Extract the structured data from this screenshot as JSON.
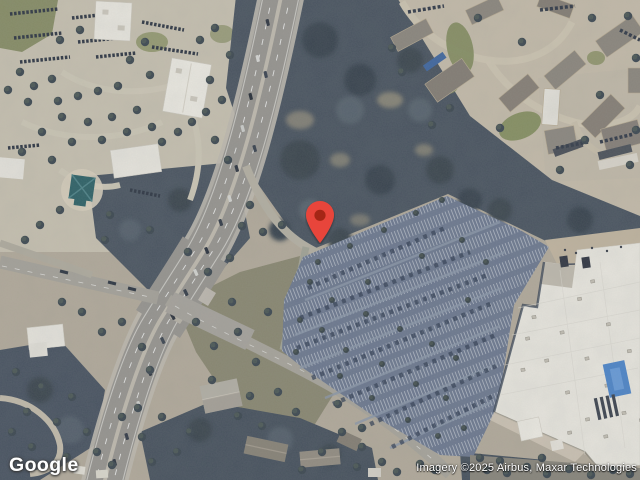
{
  "map": {
    "provider_logo": "Google",
    "attribution": "Imagery ©2025 Airbus, Maxar Technologies",
    "marker": {
      "name": "red-location-pin",
      "color": "#E8453A",
      "dot_color": "#A52714"
    }
  },
  "colors": {
    "forest": "#49535f",
    "parking_asphalt": "#6d7990",
    "store_roof": "#ece9e1",
    "highway": "#989590",
    "ground_tan": "#b4ab9b"
  }
}
